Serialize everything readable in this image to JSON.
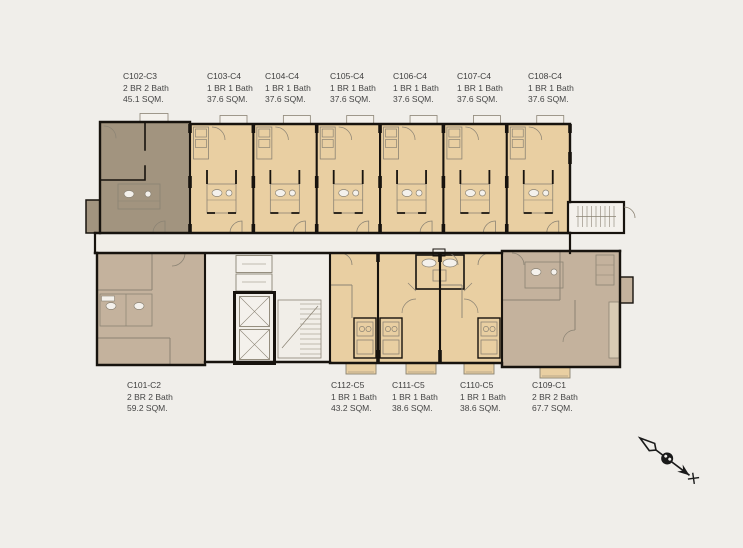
{
  "canvas": {
    "width": 743,
    "height": 548,
    "background": "#f0eeea"
  },
  "palette": {
    "unit_1br_tan": "#e9cfa2",
    "unit_2br_dark_taupe": "#a2947f",
    "unit_2br_light_taupe": "#c4b29d",
    "wall_black": "#17130e",
    "detail_gray": "#8b8374",
    "room_white": "#f4f1ec",
    "corridor": "#f1eee8",
    "label_text": "#454545"
  },
  "units": [
    {
      "code": "C102-C3",
      "type": "2 BR 2 Bath",
      "area": "45.1 SQM."
    },
    {
      "code": "C103-C4",
      "type": "1 BR 1 Bath",
      "area": "37.6 SQM."
    },
    {
      "code": "C104-C4",
      "type": "1 BR 1 Bath",
      "area": "37.6 SQM."
    },
    {
      "code": "C105-C4",
      "type": "1 BR 1 Bath",
      "area": "37.6 SQM."
    },
    {
      "code": "C106-C4",
      "type": "1 BR 1 Bath",
      "area": "37.6 SQM."
    },
    {
      "code": "C107-C4",
      "type": "1 BR 1 Bath",
      "area": "37.6 SQM."
    },
    {
      "code": "C108-C4",
      "type": "1 BR 1 Bath",
      "area": "37.6 SQM."
    },
    {
      "code": "C101-C2",
      "type": "2 BR 2 Bath",
      "area": "59.2 SQM."
    },
    {
      "code": "C112-C5",
      "type": "1 BR 1 Bath",
      "area": "43.2 SQM."
    },
    {
      "code": "C111-C5",
      "type": "1 BR 1 Bath",
      "area": "38.6 SQM."
    },
    {
      "code": "C110-C5",
      "type": "1 BR 1 Bath",
      "area": "38.6 SQM."
    },
    {
      "code": "C109-C1",
      "type": "2 BR 2 Bath",
      "area": "67.7 SQM."
    }
  ],
  "compass": {
    "name": "north-arrow"
  }
}
